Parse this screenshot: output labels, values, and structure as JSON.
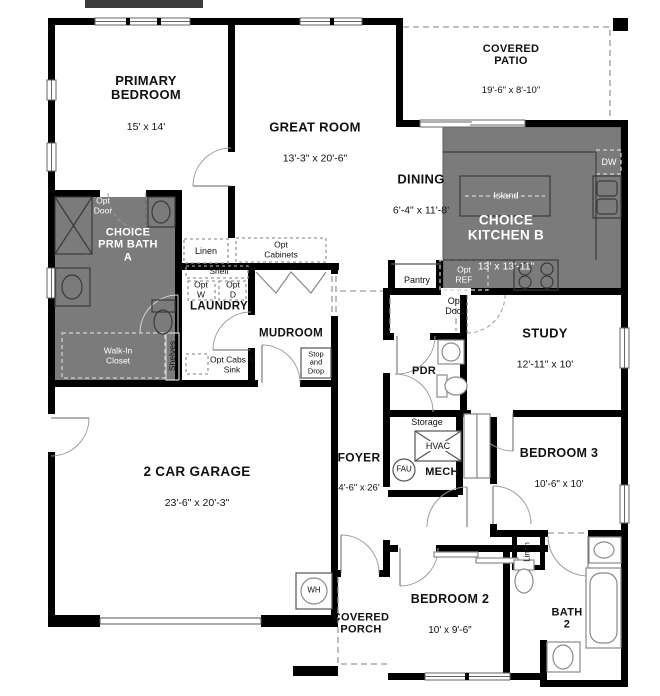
{
  "rooms": {
    "primary_bedroom": {
      "name": "PRIMARY BEDROOM",
      "dims": "15' x 14'"
    },
    "great_room": {
      "name": "GREAT ROOM",
      "dims": "13'-3\" x 20'-6\""
    },
    "covered_patio": {
      "name": "COVERED PATIO",
      "dims": "19'-6\" x 8'-10\""
    },
    "dining": {
      "name": "DINING",
      "dims": "6'-4\" x 11'-8'"
    },
    "kitchen": {
      "name": "CHOICE KITCHEN B",
      "dims": "13' x 13'-11\""
    },
    "bath_a": {
      "name": "CHOICE PRM BATH A"
    },
    "walk_in_closet": {
      "name": "Walk-In Closet"
    },
    "laundry": {
      "name": "LAUNDRY"
    },
    "mudroom": {
      "name": "MUDROOM"
    },
    "study": {
      "name": "STUDY",
      "dims": "12'-11\" x 10'"
    },
    "pdr": {
      "name": "PDR"
    },
    "mech": {
      "name": "MECH"
    },
    "foyer": {
      "name": "FOYER",
      "dims": "4'-6\" x 26'"
    },
    "garage": {
      "name": "2 CAR GARAGE",
      "dims": "23'-6\" x 20'-3\""
    },
    "covered_porch": {
      "name": "COVERED PORCH"
    },
    "bedroom_2": {
      "name": "BEDROOM 2",
      "dims": "10' x 9'-6\""
    },
    "bedroom_3": {
      "name": "BEDROOM 3",
      "dims": "10'-6\" x 10'"
    },
    "bath_2": {
      "name": "BATH 2"
    }
  },
  "labels": {
    "opt_door": "Opt Door",
    "island": "Island",
    "dw": "DW",
    "opt_ref": "Opt REF",
    "linen": "Linen",
    "opt_cabinets": "Opt Cabinets",
    "shelf": "Shelf",
    "opt_w": "Opt W",
    "opt_d": "Opt D",
    "opt_cabs_sink": "Opt Cabs & Sink",
    "shelves": "Shelves",
    "stop_and_drop": "Stop and Drop",
    "pantry": "Pantry",
    "storage": "Storage",
    "hvac": "HVAC",
    "fau": "FAU",
    "wh": "WH"
  },
  "colors": {
    "wall": "#000000",
    "room_shade": "#7b7b7b",
    "fixture_dark": "#3a3a3a",
    "fixture_light": "#8a8a8a",
    "dashed": "#999999",
    "label_on_shade": "#ffffff"
  }
}
